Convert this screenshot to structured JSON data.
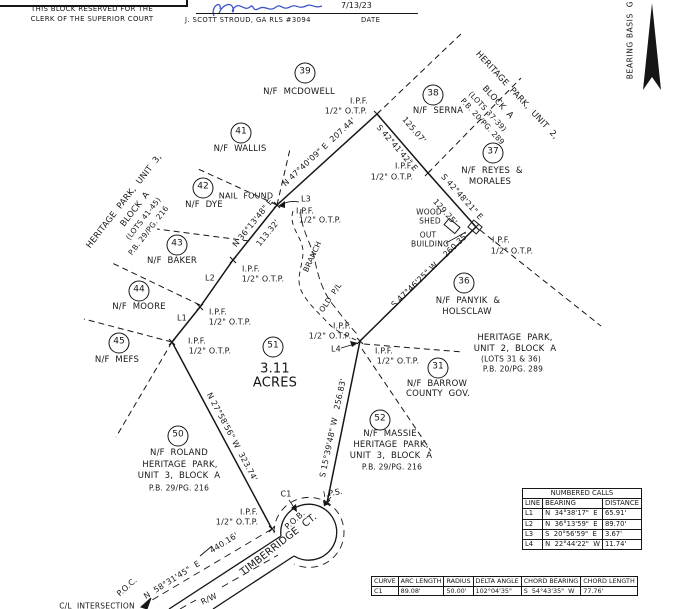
{
  "colors": {
    "ink": "#161616",
    "signature_ink": "#3c55c8",
    "paper": "#ffffff"
  },
  "clerk_box": {
    "line1": "THIS BLOCK RESERVED FOR THE",
    "line2": "CLERK OF THE SUPERIOR COURT"
  },
  "certification": {
    "date": "7/13/23",
    "surveyor": "J. SCOTT STROUD, GA RLS #3094",
    "date_label": "DATE"
  },
  "north": {
    "bearing_basis": "BEARING BASIS  G"
  },
  "plat": {
    "parcel": {
      "lot": "51",
      "acreage": "3.11 ACRES"
    },
    "lot_circles": [
      {
        "num": "39",
        "x": 305,
        "y": 73
      },
      {
        "num": "38",
        "x": 433,
        "y": 95
      },
      {
        "num": "41",
        "x": 241,
        "y": 133
      },
      {
        "num": "42",
        "x": 203,
        "y": 188
      },
      {
        "num": "43",
        "x": 177,
        "y": 245
      },
      {
        "num": "44",
        "x": 139,
        "y": 291
      },
      {
        "num": "45",
        "x": 119,
        "y": 343
      },
      {
        "num": "37",
        "x": 493,
        "y": 153
      },
      {
        "num": "36",
        "x": 464,
        "y": 283
      },
      {
        "num": "51",
        "x": 273,
        "y": 347
      },
      {
        "num": "31",
        "x": 438,
        "y": 368
      },
      {
        "num": "52",
        "x": 380,
        "y": 420
      },
      {
        "num": "50",
        "x": 178,
        "y": 436
      }
    ],
    "labels": [
      {
        "name": "owner-mcdowell",
        "text": "N/F  MCDOWELL",
        "x": 299,
        "y": 93,
        "size": 8.5
      },
      {
        "name": "ipf-top",
        "text": "I.P.F.",
        "x": 359,
        "y": 101
      },
      {
        "name": "otp-top",
        "text": "1/2\" O.T.P.",
        "x": 346,
        "y": 111
      },
      {
        "name": "owner-serna",
        "text": "N/F  SERNA",
        "x": 438,
        "y": 112,
        "size": 8.5
      },
      {
        "name": "sub-hp2-1",
        "text": "HERITAGE  PARK,  UNIT  2,",
        "x": 516,
        "y": 96,
        "rot": 47,
        "size": 8.5
      },
      {
        "name": "sub-hp2-2",
        "text": "BLOCK  A",
        "x": 497,
        "y": 103,
        "rot": 47,
        "size": 8.5
      },
      {
        "name": "sub-hp2-3",
        "text": "(LOTS 37-39)",
        "x": 487,
        "y": 112,
        "rot": 47,
        "size": 7.5
      },
      {
        "name": "sub-hp2-4",
        "text": "P.B. 20/PG. 289",
        "x": 482,
        "y": 122,
        "rot": 47,
        "size": 7.5
      },
      {
        "name": "owner-wallis",
        "text": "N/F  WALLIS",
        "x": 240,
        "y": 150,
        "size": 8.5
      },
      {
        "name": "sub-hp3-1",
        "text": "HERITAGE  PARK,  UNIT  3,",
        "x": 125,
        "y": 202,
        "rot": -52,
        "size": 8.5
      },
      {
        "name": "sub-hp3-2",
        "text": "BLOCK  A",
        "x": 136,
        "y": 210,
        "rot": -52,
        "size": 8.5
      },
      {
        "name": "sub-hp3-3",
        "text": "(LOTS 41-45)",
        "x": 144,
        "y": 219,
        "rot": -52,
        "size": 7.5
      },
      {
        "name": "sub-hp3-4",
        "text": "P.B. 29/PG. 216",
        "x": 149,
        "y": 231,
        "rot": -52,
        "size": 7.5
      },
      {
        "name": "owner-dye",
        "text": "N/F  DYE",
        "x": 204,
        "y": 206,
        "size": 8.5
      },
      {
        "name": "nail-found",
        "text": "NAIL  FOUND",
        "x": 246,
        "y": 196
      },
      {
        "name": "line-l3",
        "text": "L3",
        "x": 306,
        "y": 199
      },
      {
        "name": "ipf-nail",
        "text": "I.P.F.",
        "x": 305,
        "y": 211
      },
      {
        "name": "otp-nail",
        "text": "1/2\" O.T.P.",
        "x": 320,
        "y": 220
      },
      {
        "name": "bearing-207",
        "text": "N 47°40'09\" E  207.44'",
        "x": 319,
        "y": 152,
        "rot": -43
      },
      {
        "name": "dist-12507",
        "text": "125.07'",
        "x": 414,
        "y": 130,
        "rot": 49
      },
      {
        "name": "bearing-4241",
        "text": "S 42°41'42\" E",
        "x": 397,
        "y": 148,
        "rot": 49
      },
      {
        "name": "owner-reyes-1",
        "text": "N/F  REYES  &",
        "x": 492,
        "y": 172,
        "size": 8.5
      },
      {
        "name": "owner-reyes-2",
        "text": "MORALES",
        "x": 490,
        "y": 183,
        "size": 8.5
      },
      {
        "name": "ipf-b",
        "text": "I.P.F.",
        "x": 404,
        "y": 166
      },
      {
        "name": "otp-b",
        "text": "1/2\" O.T.P.",
        "x": 392,
        "y": 177
      },
      {
        "name": "bearing-4248",
        "text": "S 42°48'21\" E",
        "x": 462,
        "y": 197,
        "rot": 48
      },
      {
        "name": "dist-12925",
        "text": "129.25'",
        "x": 445,
        "y": 212,
        "rot": 48
      },
      {
        "name": "wood-shed-1",
        "text": "WOOD",
        "x": 429,
        "y": 213,
        "size": 7.5
      },
      {
        "name": "wood-shed-2",
        "text": "SHED",
        "x": 430,
        "y": 222,
        "size": 7.5
      },
      {
        "name": "out-building-1",
        "text": "OUT",
        "x": 428,
        "y": 236,
        "size": 7.5
      },
      {
        "name": "out-building-2",
        "text": "BUILDING",
        "x": 430,
        "y": 245,
        "size": 7.5
      },
      {
        "name": "ipf-c",
        "text": "I.P.F.",
        "x": 501,
        "y": 240
      },
      {
        "name": "otp-c",
        "text": "1/2\" O.T.P.",
        "x": 512,
        "y": 251
      },
      {
        "name": "owner-panyik-1",
        "text": "N/F  PANYIK  &",
        "x": 468,
        "y": 302,
        "size": 8.5
      },
      {
        "name": "owner-panyik-2",
        "text": "HOLSCLAW",
        "x": 467,
        "y": 313,
        "size": 8.5
      },
      {
        "name": "bearing-260",
        "text": "S 47°46'25\" W    260.35'",
        "x": 430,
        "y": 270,
        "rot": -44
      },
      {
        "name": "sub-hp2b-1",
        "text": "HERITAGE  PARK,",
        "x": 515,
        "y": 339,
        "size": 8.5
      },
      {
        "name": "sub-hp2b-2",
        "text": "UNIT  2,  BLOCK  A",
        "x": 515,
        "y": 350,
        "size": 8.5
      },
      {
        "name": "sub-hp2b-3",
        "text": "(LOTS 31 & 36)",
        "x": 511,
        "y": 360,
        "size": 7.5
      },
      {
        "name": "sub-hp2b-4",
        "text": "P.B. 20/PG. 289",
        "x": 513,
        "y": 370,
        "size": 7.5
      },
      {
        "name": "owner-barrow-1",
        "text": "N/F  BARROW",
        "x": 437,
        "y": 385,
        "size": 8.5
      },
      {
        "name": "owner-barrow-2",
        "text": "COUNTY  GOV.",
        "x": 438,
        "y": 395,
        "size": 8.5
      },
      {
        "name": "bearing-256",
        "text": "S 15°39'48\" W   256.83'",
        "x": 333,
        "y": 428,
        "rot": -78
      },
      {
        "name": "owner-massie",
        "text": "N/F  MASSIE",
        "x": 390,
        "y": 435,
        "size": 8.5
      },
      {
        "name": "sub-hp3b-1",
        "text": "HERITAGE  PARK,",
        "x": 391,
        "y": 446,
        "size": 8.5
      },
      {
        "name": "sub-hp3b-2",
        "text": "UNIT  3,  BLOCK  A",
        "x": 391,
        "y": 457,
        "size": 8.5
      },
      {
        "name": "sub-hp3b-3",
        "text": "P.B. 29/PG. 216",
        "x": 392,
        "y": 468,
        "size": 7.5
      },
      {
        "name": "owner-baker",
        "text": "N/F  BAKER",
        "x": 172,
        "y": 262,
        "size": 8.5
      },
      {
        "name": "line-l2",
        "text": "L2",
        "x": 210,
        "y": 278
      },
      {
        "name": "ipf-l2",
        "text": "I.P.F.",
        "x": 251,
        "y": 269
      },
      {
        "name": "otp-l2",
        "text": "1/2\" O.T.P.",
        "x": 263,
        "y": 279
      },
      {
        "name": "bearing-3613",
        "text": "N 36°13'48\" E",
        "x": 253,
        "y": 223,
        "rot": -51
      },
      {
        "name": "dist-11332",
        "text": "113.32'",
        "x": 268,
        "y": 233,
        "rot": -51
      },
      {
        "name": "owner-moore",
        "text": "N/F  MOORE",
        "x": 139,
        "y": 308,
        "size": 8.5
      },
      {
        "name": "line-l1",
        "text": "L1",
        "x": 182,
        "y": 318
      },
      {
        "name": "ipf-l1",
        "text": "I.P.F.",
        "x": 218,
        "y": 312
      },
      {
        "name": "otp-l1",
        "text": "1/2\" O.T.P.",
        "x": 230,
        "y": 322
      },
      {
        "name": "ipf-mefs",
        "text": "I.P.F.",
        "x": 197,
        "y": 341
      },
      {
        "name": "otp-mefs",
        "text": "1/2\" O.T.P.",
        "x": 210,
        "y": 351
      },
      {
        "name": "owner-mefs",
        "text": "N/F  MEFS",
        "x": 117,
        "y": 361,
        "size": 8.5
      },
      {
        "name": "acreage-1",
        "text": "3.11",
        "x": 275,
        "y": 370,
        "size": 13
      },
      {
        "name": "acreage-2",
        "text": "ACRES",
        "x": 275,
        "y": 384,
        "size": 13
      },
      {
        "name": "ipf-l4-a",
        "text": "I.P.F.",
        "x": 342,
        "y": 326
      },
      {
        "name": "otp-l4-a",
        "text": "1/2\" O.T.P.",
        "x": 330,
        "y": 336
      },
      {
        "name": "line-l4",
        "text": "L4",
        "x": 336,
        "y": 349
      },
      {
        "name": "ipf-l4-b",
        "text": "I.P.F.",
        "x": 384,
        "y": 351
      },
      {
        "name": "otp-l4-b",
        "text": "1/2\" O.T.P.",
        "x": 398,
        "y": 361
      },
      {
        "name": "branch-label",
        "text": "BRANCH",
        "x": 313,
        "y": 257,
        "rot": -65,
        "size": 7.5
      },
      {
        "name": "old-pl-label",
        "text": "OLD  P/L",
        "x": 331,
        "y": 298,
        "rot": -56,
        "size": 7.5
      },
      {
        "name": "bearing-323",
        "text": "N 27°58'56\" W  323.74'",
        "x": 232,
        "y": 437,
        "rot": 62
      },
      {
        "name": "owner-roland",
        "text": "N/F  ROLAND",
        "x": 179,
        "y": 454,
        "size": 8.5
      },
      {
        "name": "sub-hp3r-1",
        "text": "HERITAGE  PARK,",
        "x": 180,
        "y": 466,
        "size": 8.5
      },
      {
        "name": "sub-hp3r-2",
        "text": "UNIT  3,  BLOCK  A",
        "x": 179,
        "y": 477,
        "size": 8.5
      },
      {
        "name": "sub-hp3r-3",
        "text": "P.B. 29/PG. 216",
        "x": 179,
        "y": 489,
        "size": 7.5
      },
      {
        "name": "curve-c1-label",
        "text": "C1",
        "x": 286,
        "y": 494
      },
      {
        "name": "ips-label",
        "text": "I.P.S.",
        "x": 333,
        "y": 493,
        "rot": -10
      },
      {
        "name": "ipf-pob",
        "text": "I.P.F.",
        "x": 249,
        "y": 512
      },
      {
        "name": "otp-pob",
        "text": "1/2\" O.T.P.",
        "x": 237,
        "y": 522
      },
      {
        "name": "pob-label",
        "text": "P.O.B.",
        "x": 295,
        "y": 520,
        "rot": -42
      },
      {
        "name": "street-name",
        "text": "TIMBERRIDGE  CT.",
        "x": 279,
        "y": 545,
        "rot": -38,
        "size": 10
      },
      {
        "name": "dist-44016",
        "text": "440.16'",
        "x": 224,
        "y": 543,
        "rot": -32
      },
      {
        "name": "bearing-5831",
        "text": "N  58°31'45\"  E",
        "x": 172,
        "y": 580,
        "rot": -32
      },
      {
        "name": "rw-label",
        "text": "R/W",
        "x": 209,
        "y": 599,
        "rot": -25
      },
      {
        "name": "poc-label",
        "text": "P.O.C.",
        "x": 127,
        "y": 587,
        "rot": -42
      },
      {
        "name": "cl-intersection",
        "text": "C/L  INTERSECTION",
        "x": 97,
        "y": 607,
        "size": 7.5
      }
    ]
  },
  "tables": {
    "numbered_calls": {
      "title": "NUMBERED CALLS",
      "headers": [
        "LINE",
        "BEARING",
        "DISTANCE"
      ],
      "rows": [
        [
          "L1",
          "N  34°38'17\"  E",
          "65.91'"
        ],
        [
          "L2",
          "N  36°13'59\"  E",
          "89.70'"
        ],
        [
          "L3",
          "S  20°56'59\"  E",
          "3.67'"
        ],
        [
          "L4",
          "N  22°44'22\"  W",
          "11.74'"
        ]
      ]
    },
    "curve_table": {
      "headers": [
        "CURVE",
        "ARC LENGTH",
        "RADIUS",
        "DELTA ANGLE",
        "CHORD BEARING",
        "CHORD LENGTH"
      ],
      "rows": [
        [
          "C1",
          "89.08'",
          "50.00'",
          "102°04'35\"",
          "S  54°43'35\"  W",
          "77.76'"
        ]
      ]
    }
  }
}
